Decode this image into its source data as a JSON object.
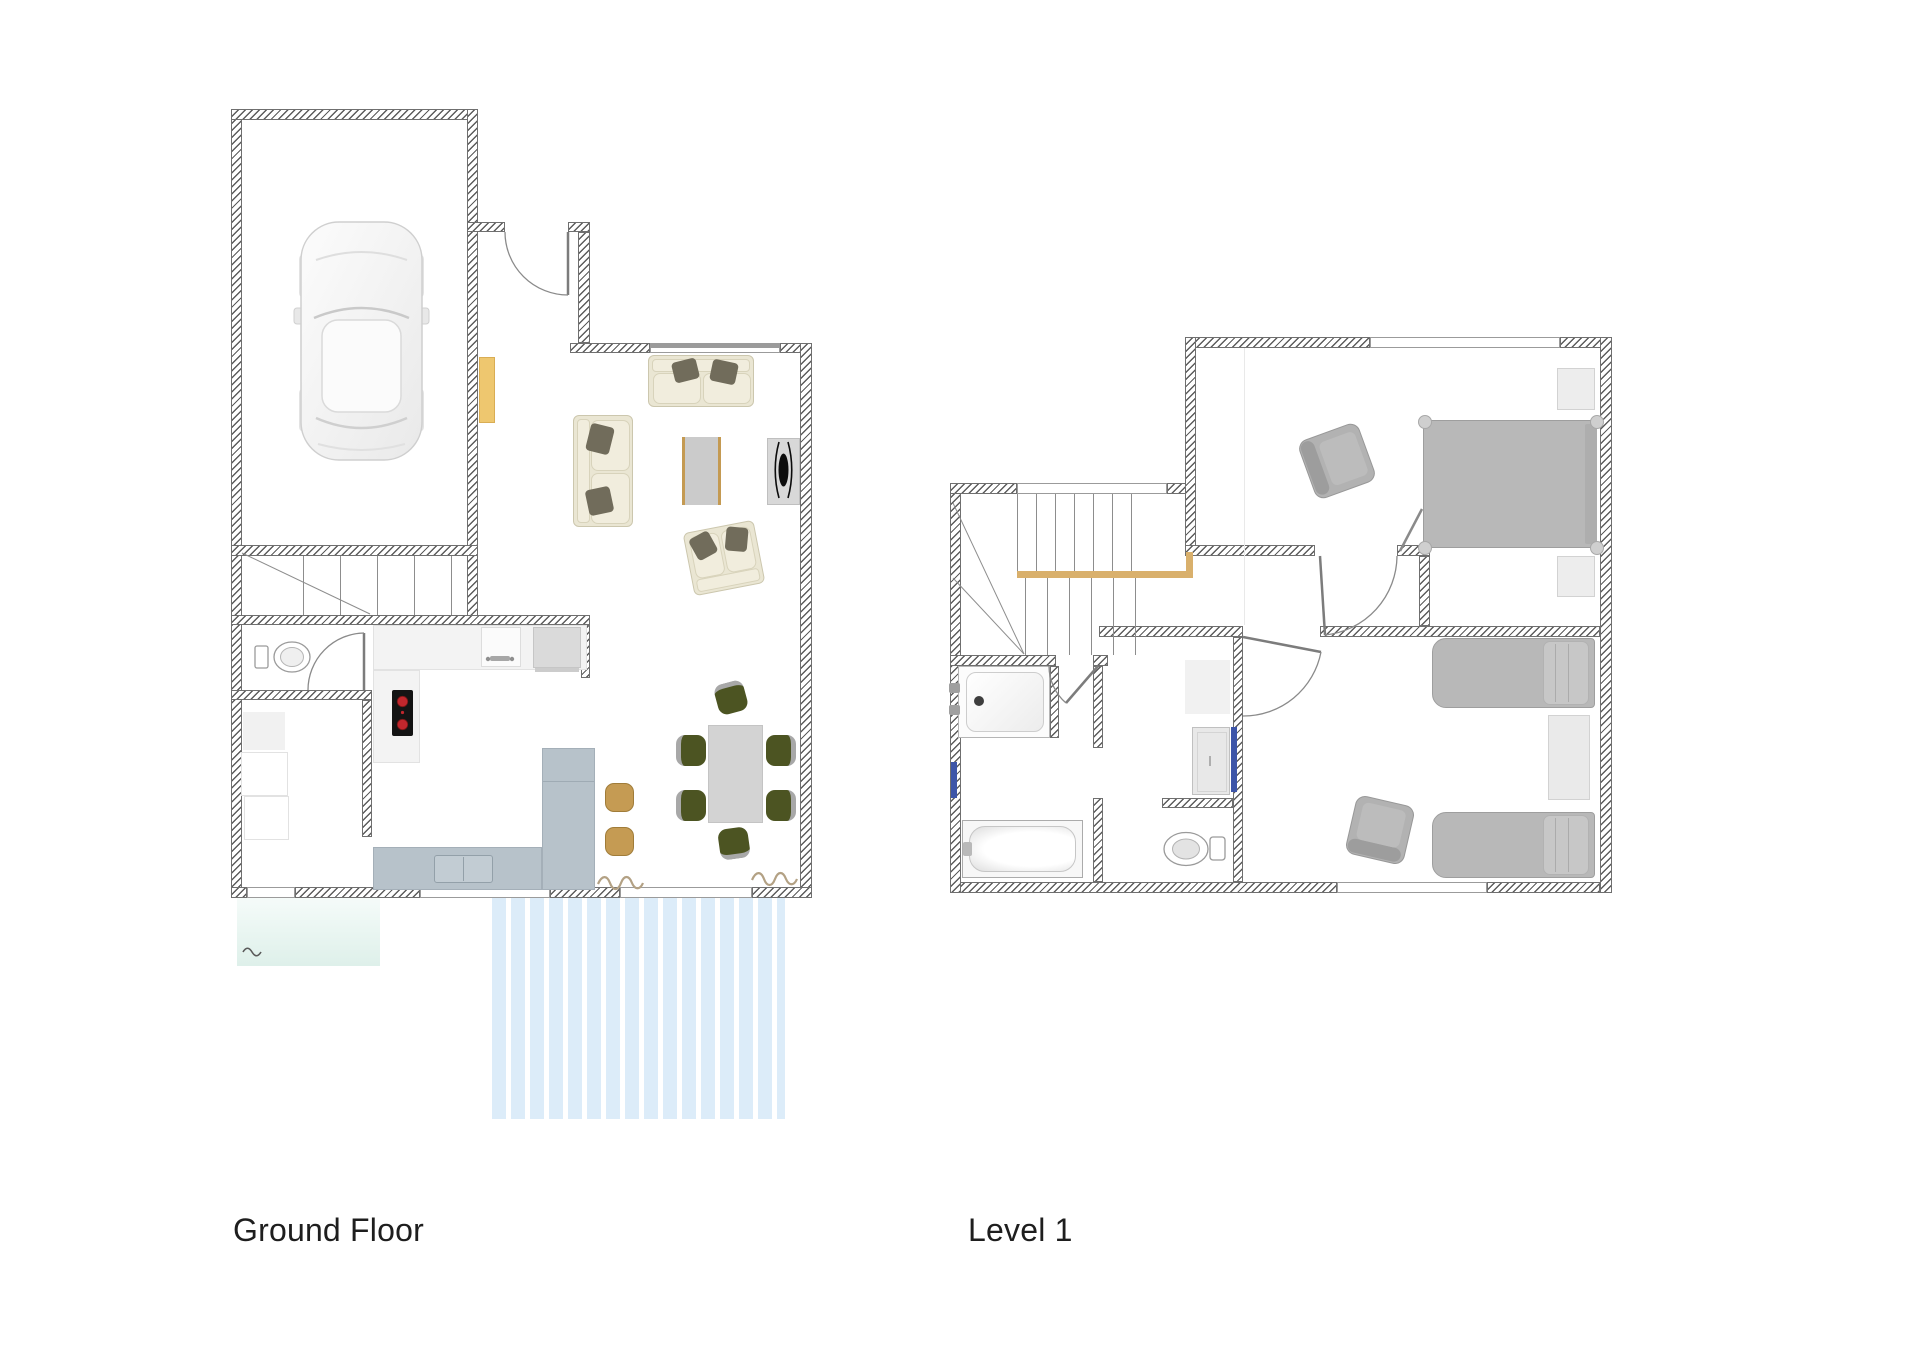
{
  "page": {
    "background": "#ffffff"
  },
  "labels": {
    "ground_floor": "Ground Floor",
    "level_1": "Level 1"
  },
  "palette": {
    "wall_hatch": "#5c5c5c",
    "railing_wood": "#d9b06c",
    "cabinet_yellow": "#eec76f",
    "deck_blue": "#dcecf9",
    "patio_aqua": "#e4f3ee",
    "island_blue_gray": "#b7c2ca",
    "stool_tan": "#c59b53",
    "dining_chair_olive": "#4c5422",
    "sofa_cream": "#eae6d3",
    "pillow_taupe": "#716c5b",
    "bed_gray": "#b8b8b8",
    "burner_red": "#c1272d",
    "strip_blue": "#3d55a8"
  },
  "floors": [
    {
      "id": "ground-floor",
      "label": "Ground Floor",
      "rooms": [
        "garage",
        "entry",
        "stairs",
        "wc",
        "laundry",
        "kitchen",
        "living-room",
        "dining-area",
        "deck",
        "patio"
      ],
      "furniture": [
        "car",
        "toilet",
        "laundry-appliances",
        "stove",
        "kitchen-counters",
        "kitchen-island",
        "island-sink",
        "bar-stools",
        "dining-table",
        "dining-chairs-x6",
        "sofa",
        "sofa-2",
        "loveseat",
        "coffee-table",
        "tv-unit",
        "yellow-cabinet",
        "decor-plants"
      ]
    },
    {
      "id": "level-1",
      "label": "Level 1",
      "rooms": [
        "stairs",
        "hallway",
        "bathroom",
        "wc",
        "wardrobe-nook",
        "bedroom-1",
        "bedroom-2"
      ],
      "furniture": [
        "double-bed",
        "nightstand-x2",
        "armchair",
        "shower",
        "bathtub",
        "toilet",
        "wardrobe",
        "twin-bed-x2",
        "bedside-table",
        "armchair-2"
      ]
    }
  ]
}
